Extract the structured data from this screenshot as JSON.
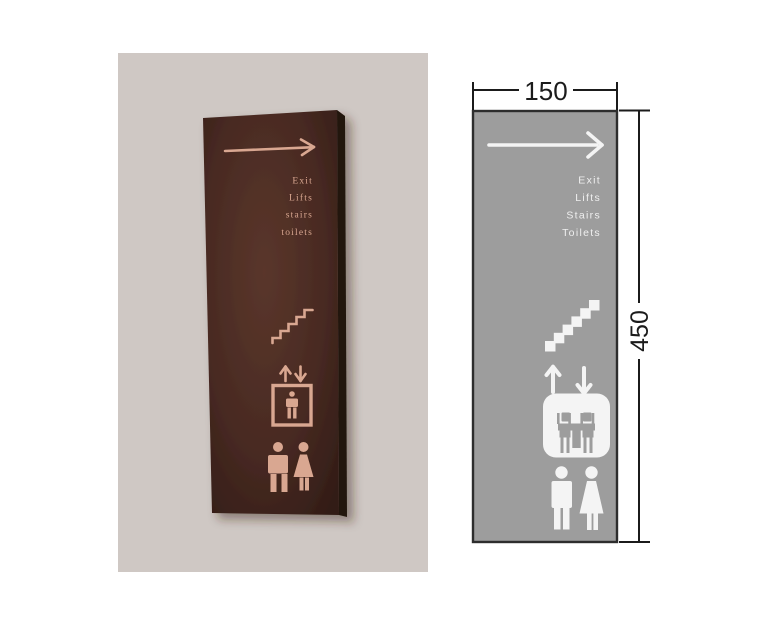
{
  "photo": {
    "description": "photo of wall-mounted directional sign",
    "background_color": "#cfc8c4",
    "panel_color": "#4a2b23",
    "panel_edge_color": "#241410",
    "print_color": "#d9a791",
    "labels": [
      "Exit",
      "Lifts",
      "stairs",
      "toilets"
    ],
    "icons": [
      "right-arrow-icon",
      "stairs-icon",
      "lift-icon",
      "mens-icon",
      "womens-icon"
    ]
  },
  "diagram": {
    "description": "dimensioned drawing of sign panel",
    "panel_color": "#9d9d9d",
    "outline_color": "#2d2d2d",
    "print_color": "#f4f4f4",
    "dimension_color": "#1b1b1b",
    "labels": [
      "Exit",
      "Lifts",
      "Stairs",
      "Toilets"
    ],
    "width_label": "150",
    "height_label": "450",
    "icons": [
      "right-arrow-icon",
      "stairs-icon",
      "lift-up-arrow-icon",
      "lift-down-arrow-icon",
      "lift-icon",
      "mens-icon",
      "womens-icon"
    ]
  }
}
